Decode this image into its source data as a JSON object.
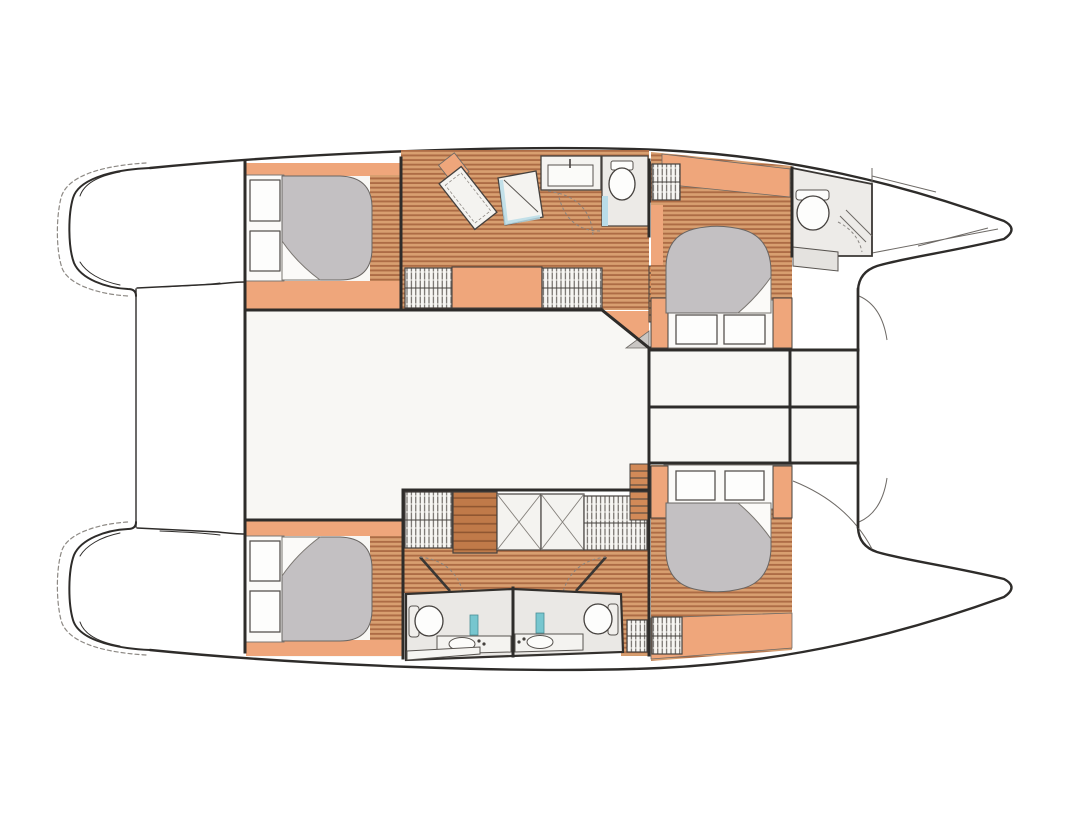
{
  "diagram": {
    "type": "boat-floor-plan",
    "subject": "Catamaran interior deck plan, top view, bows pointing right",
    "rooms": [
      "port aft cabin with double berth",
      "port forward cabin with double berth and en-suite head",
      "starboard aft cabin with double berth",
      "starboard forward cabin with double berth",
      "central saloon",
      "forward head with shower, basin and toilet",
      "twin aft heads with toilets and basins",
      "midship storage compartments",
      "aft swim platforms",
      "bow lockers"
    ],
    "elements": [
      "double berth x4",
      "gray mattress with folded sheet x4",
      "pillows x8",
      "hatched wardrobe lockers",
      "shower stall with glass screen",
      "wash basin counter x3",
      "toilet x4",
      "angled chart desk",
      "companionway stairs x2",
      "cross-hatched lockers x2",
      "swim platform steps x2",
      "bow bulkhead and anchor locker lines"
    ]
  },
  "colors": {
    "paper": "#ffffff",
    "line": "#2e2c2a",
    "line-soft": "#7d7874",
    "wood-light": "#d89f70",
    "wood-dark": "#ad6c45",
    "orange": "#efa67b",
    "stair": "#d28a58",
    "cabinet": "#c07a49",
    "cabinet-line": "#8f5631",
    "mattress": "#c3c0c2",
    "room": "#f8f7f4",
    "bath": "#eae8e5",
    "fixture": "#f4f3f0",
    "teal": "#77c6cf",
    "blue": "#b9dce8"
  }
}
